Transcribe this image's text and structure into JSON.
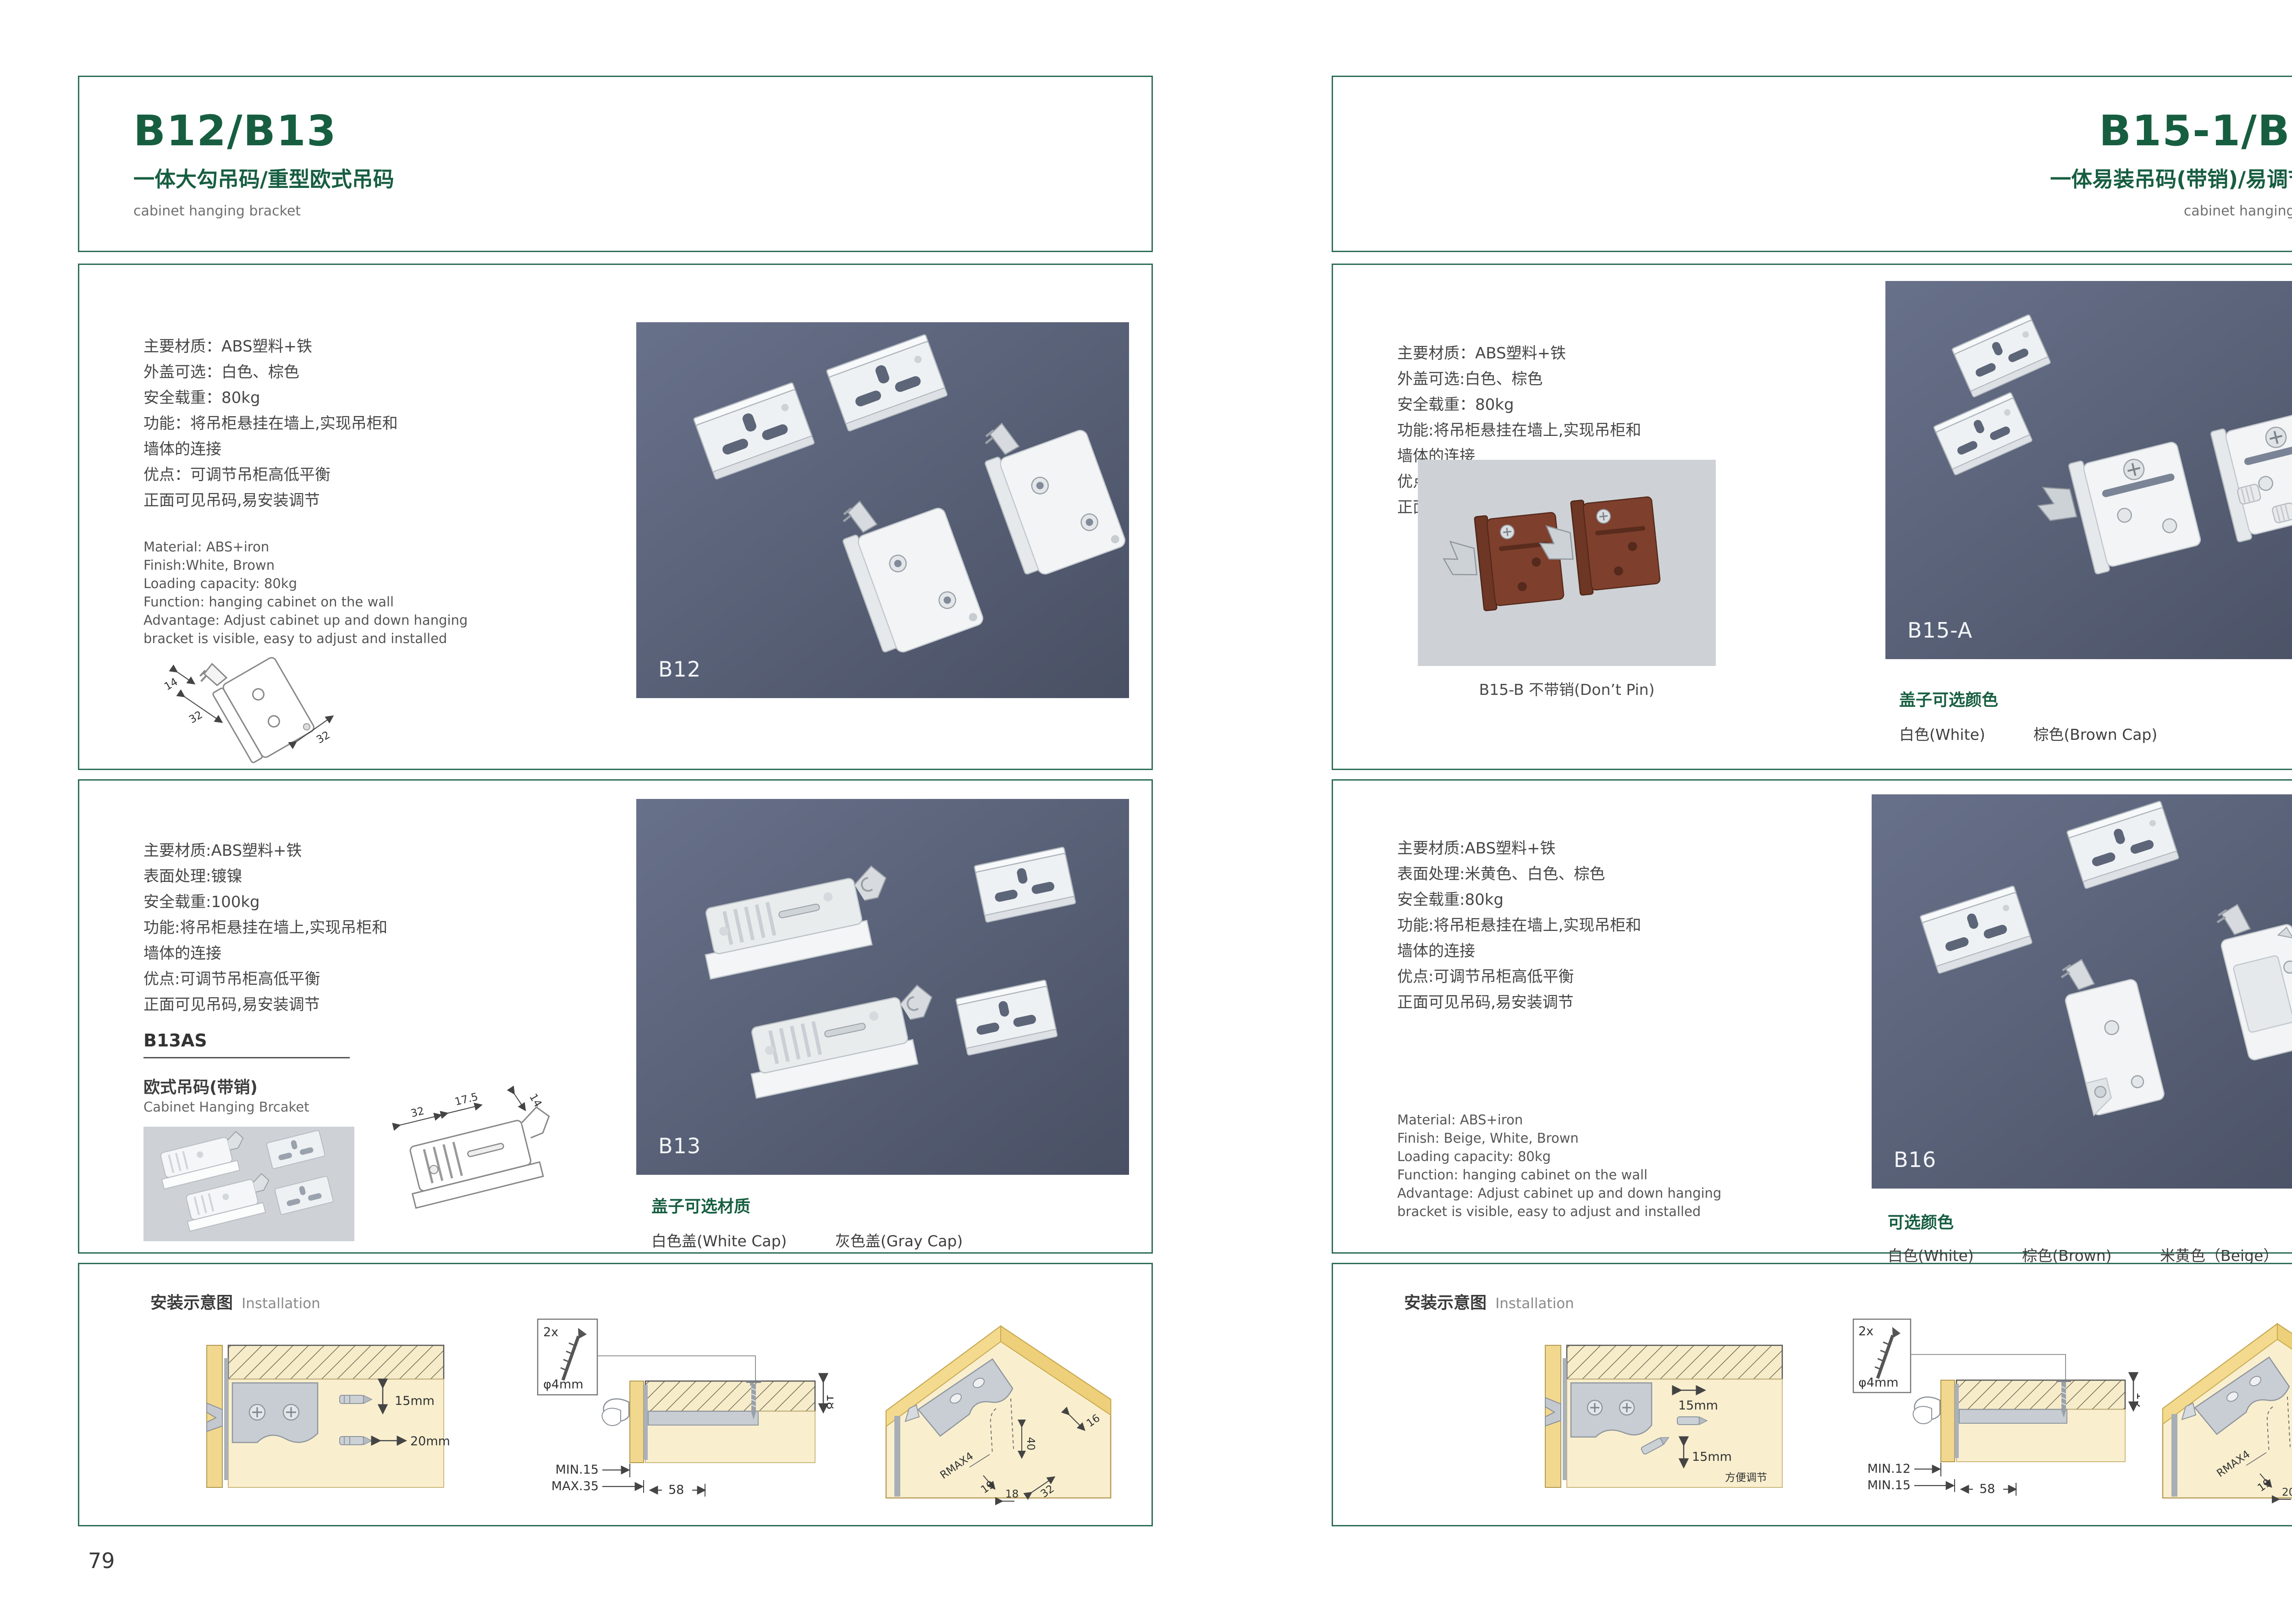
{
  "colors": {
    "accent_green": "#175E41",
    "border_green": "#2F6E58",
    "photo_bg_dark": "#525B71",
    "photo_bg_light": "#CED2D6",
    "wood_yellow": "#F2D88E",
    "panel_cream": "#F9EFCF"
  },
  "page_left": {
    "page_number": "79",
    "header": {
      "title": "B12/B13",
      "subtitle": "一体大勾吊码/重型欧式吊码",
      "category": "cabinet hanging bracket"
    },
    "section1": {
      "specs_cn": [
        "主要材质：ABS塑料+铁",
        "外盖可选：白色、棕色",
        "安全载重：80kg",
        "功能：将吊柜悬挂在墙上,实现吊柜和",
        "墙体的连接",
        "优点：可调节吊柜高低平衡",
        "正面可见吊码,易安装调节"
      ],
      "specs_en": [
        "Material: ABS+iron",
        "Finish:White, Brown",
        "Loading capacity: 80kg",
        "Function: hanging cabinet on the wall",
        "Advantage: Adjust cabinet up and down hanging",
        "bracket is visible, easy to adjust and installed"
      ],
      "drawing_dims": [
        "14",
        "32",
        "32"
      ],
      "product_label": "B12"
    },
    "section2": {
      "specs_cn": [
        "主要材质:ABS塑料+铁",
        "表面处理:镀镍",
        "安全载重:100kg",
        "功能:将吊柜悬挂在墙上,实现吊柜和",
        "墙体的连接",
        "优点:可调节吊柜高低平衡",
        "正面可见吊码,易安装调节"
      ],
      "model_code": "B13AS",
      "model_name_cn": "欧式吊码(带销)",
      "model_name_en": "Cabinet Hanging Brcaket",
      "drawing_dims": [
        "32",
        "17.5",
        "14"
      ],
      "product_label": "B13",
      "options_title": "盖子可选材质",
      "options": [
        "白色盖(White Cap)",
        "灰色盖(Gray Cap)"
      ]
    },
    "installation": {
      "title_cn": "安装示意图",
      "title_en": "Installation",
      "diagram1_dims": [
        "15mm",
        "20mm"
      ],
      "diagram2": {
        "screw_count": "2x",
        "screw_dia": "φ4mm",
        "side_dim": "18",
        "bottom_dims": [
          "MIN.15",
          "MAX.35",
          "58"
        ]
      },
      "diagram3_dims": [
        "16",
        "40",
        "RMAX4",
        "19",
        "18",
        "32"
      ]
    }
  },
  "page_right": {
    "page_number": "80",
    "header": {
      "title": "B15-1/B16",
      "subtitle": "一体易装吊码(带销)/易调节吊码",
      "category": "cabinet hanging bracket"
    },
    "section1": {
      "specs_cn": [
        "主要材质：ABS塑料+铁",
        "外盖可选:白色、棕色",
        "安全载重：80kg",
        "功能:将吊柜悬挂在墙上,实现吊柜和",
        "墙体的连接",
        "优点:可调节吊柜高低平衡",
        "正面可见吊码,易安装调节"
      ],
      "photo_caption": "B15-B 不带销(Don’t Pin)",
      "product_label": "B15-A",
      "options_title": "盖子可选颜色",
      "options": [
        "白色(White)",
        "棕色(Brown Cap)"
      ]
    },
    "section2": {
      "specs_cn": [
        "主要材质:ABS塑料+铁",
        "表面处理:米黄色、白色、棕色",
        "安全载重:80kg",
        "功能:将吊柜悬挂在墙上,实现吊柜和",
        "墙体的连接",
        "优点:可调节吊柜高低平衡",
        "正面可见吊码,易安装调节"
      ],
      "specs_en": [
        "Material: ABS+iron",
        "Finish: Beige, White, Brown",
        "Loading capacity: 80kg",
        "Function: hanging cabinet on the wall",
        "Advantage: Adjust cabinet up and down hanging",
        "bracket is visible, easy to adjust and installed"
      ],
      "product_label": "B16",
      "options_title": "可选颜色",
      "options": [
        "白色(White)",
        "棕色(Brown)",
        "米黄色（Beige）"
      ]
    },
    "installation": {
      "title_cn": "安装示意图",
      "title_en": "Installation",
      "diagram1_dims": [
        "15mm",
        "15mm"
      ],
      "diagram1_note": "方便调节",
      "diagram2": {
        "screw_count": "2x",
        "screw_dia": "φ4mm",
        "side_dim": "19",
        "bottom_dims": [
          "MIN.12",
          "MIN.15",
          "58"
        ]
      },
      "diagram3_dims": [
        "30",
        "32",
        "RMAX4",
        "19",
        "20",
        "32"
      ]
    }
  }
}
